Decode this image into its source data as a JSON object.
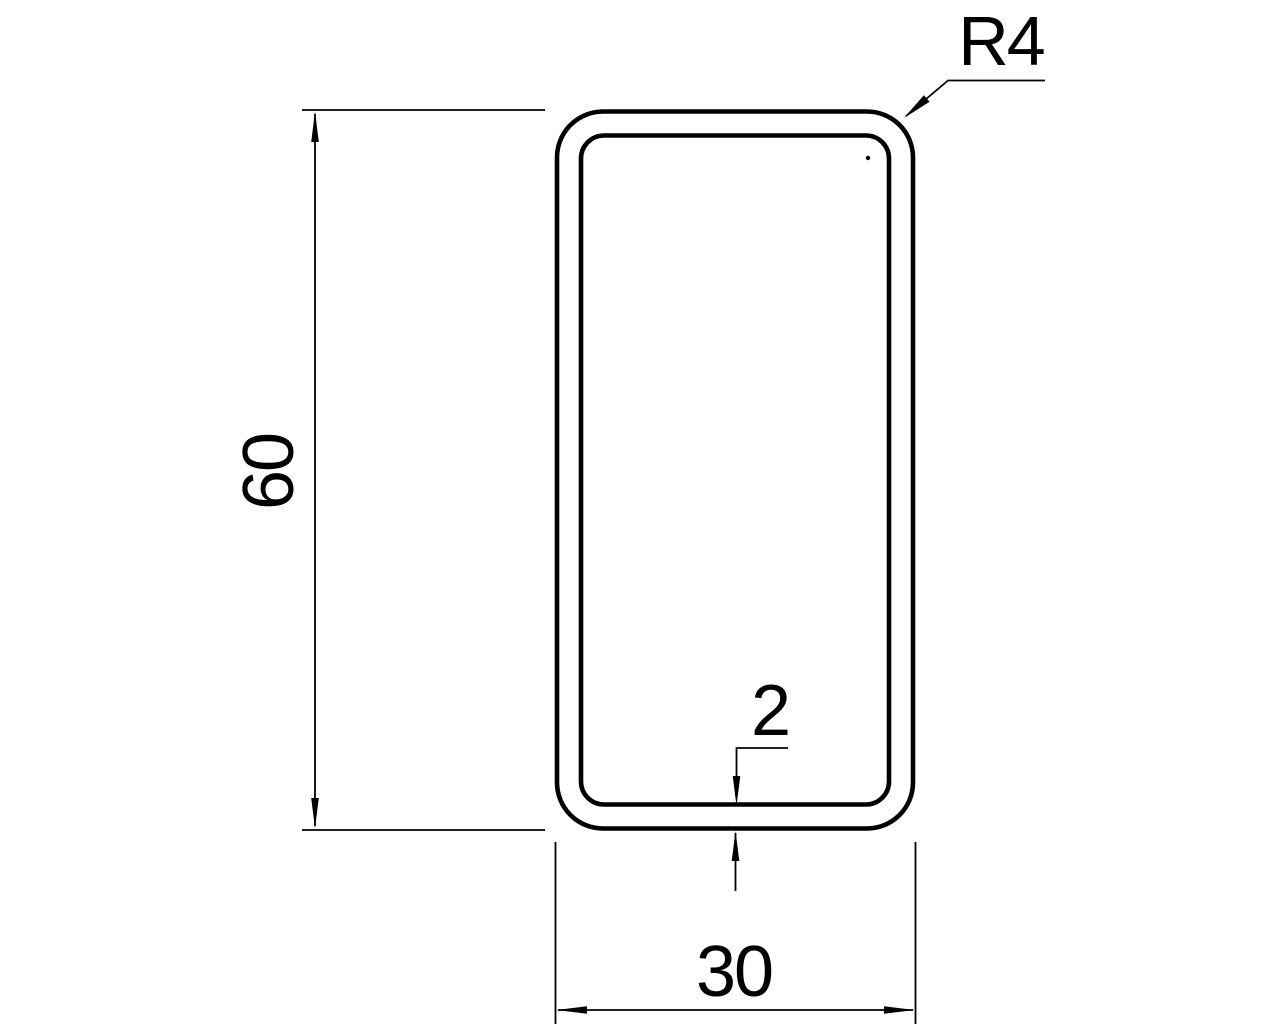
{
  "drawing": {
    "labels": {
      "height": "60",
      "width": "30",
      "thickness": "2",
      "corner_radius": "R4"
    },
    "dimensions": {
      "height": 60,
      "width": 30,
      "wall_thickness": 2,
      "corner_radius": 4
    },
    "colors": {
      "line": "#000000",
      "background": "#ffffff"
    }
  }
}
